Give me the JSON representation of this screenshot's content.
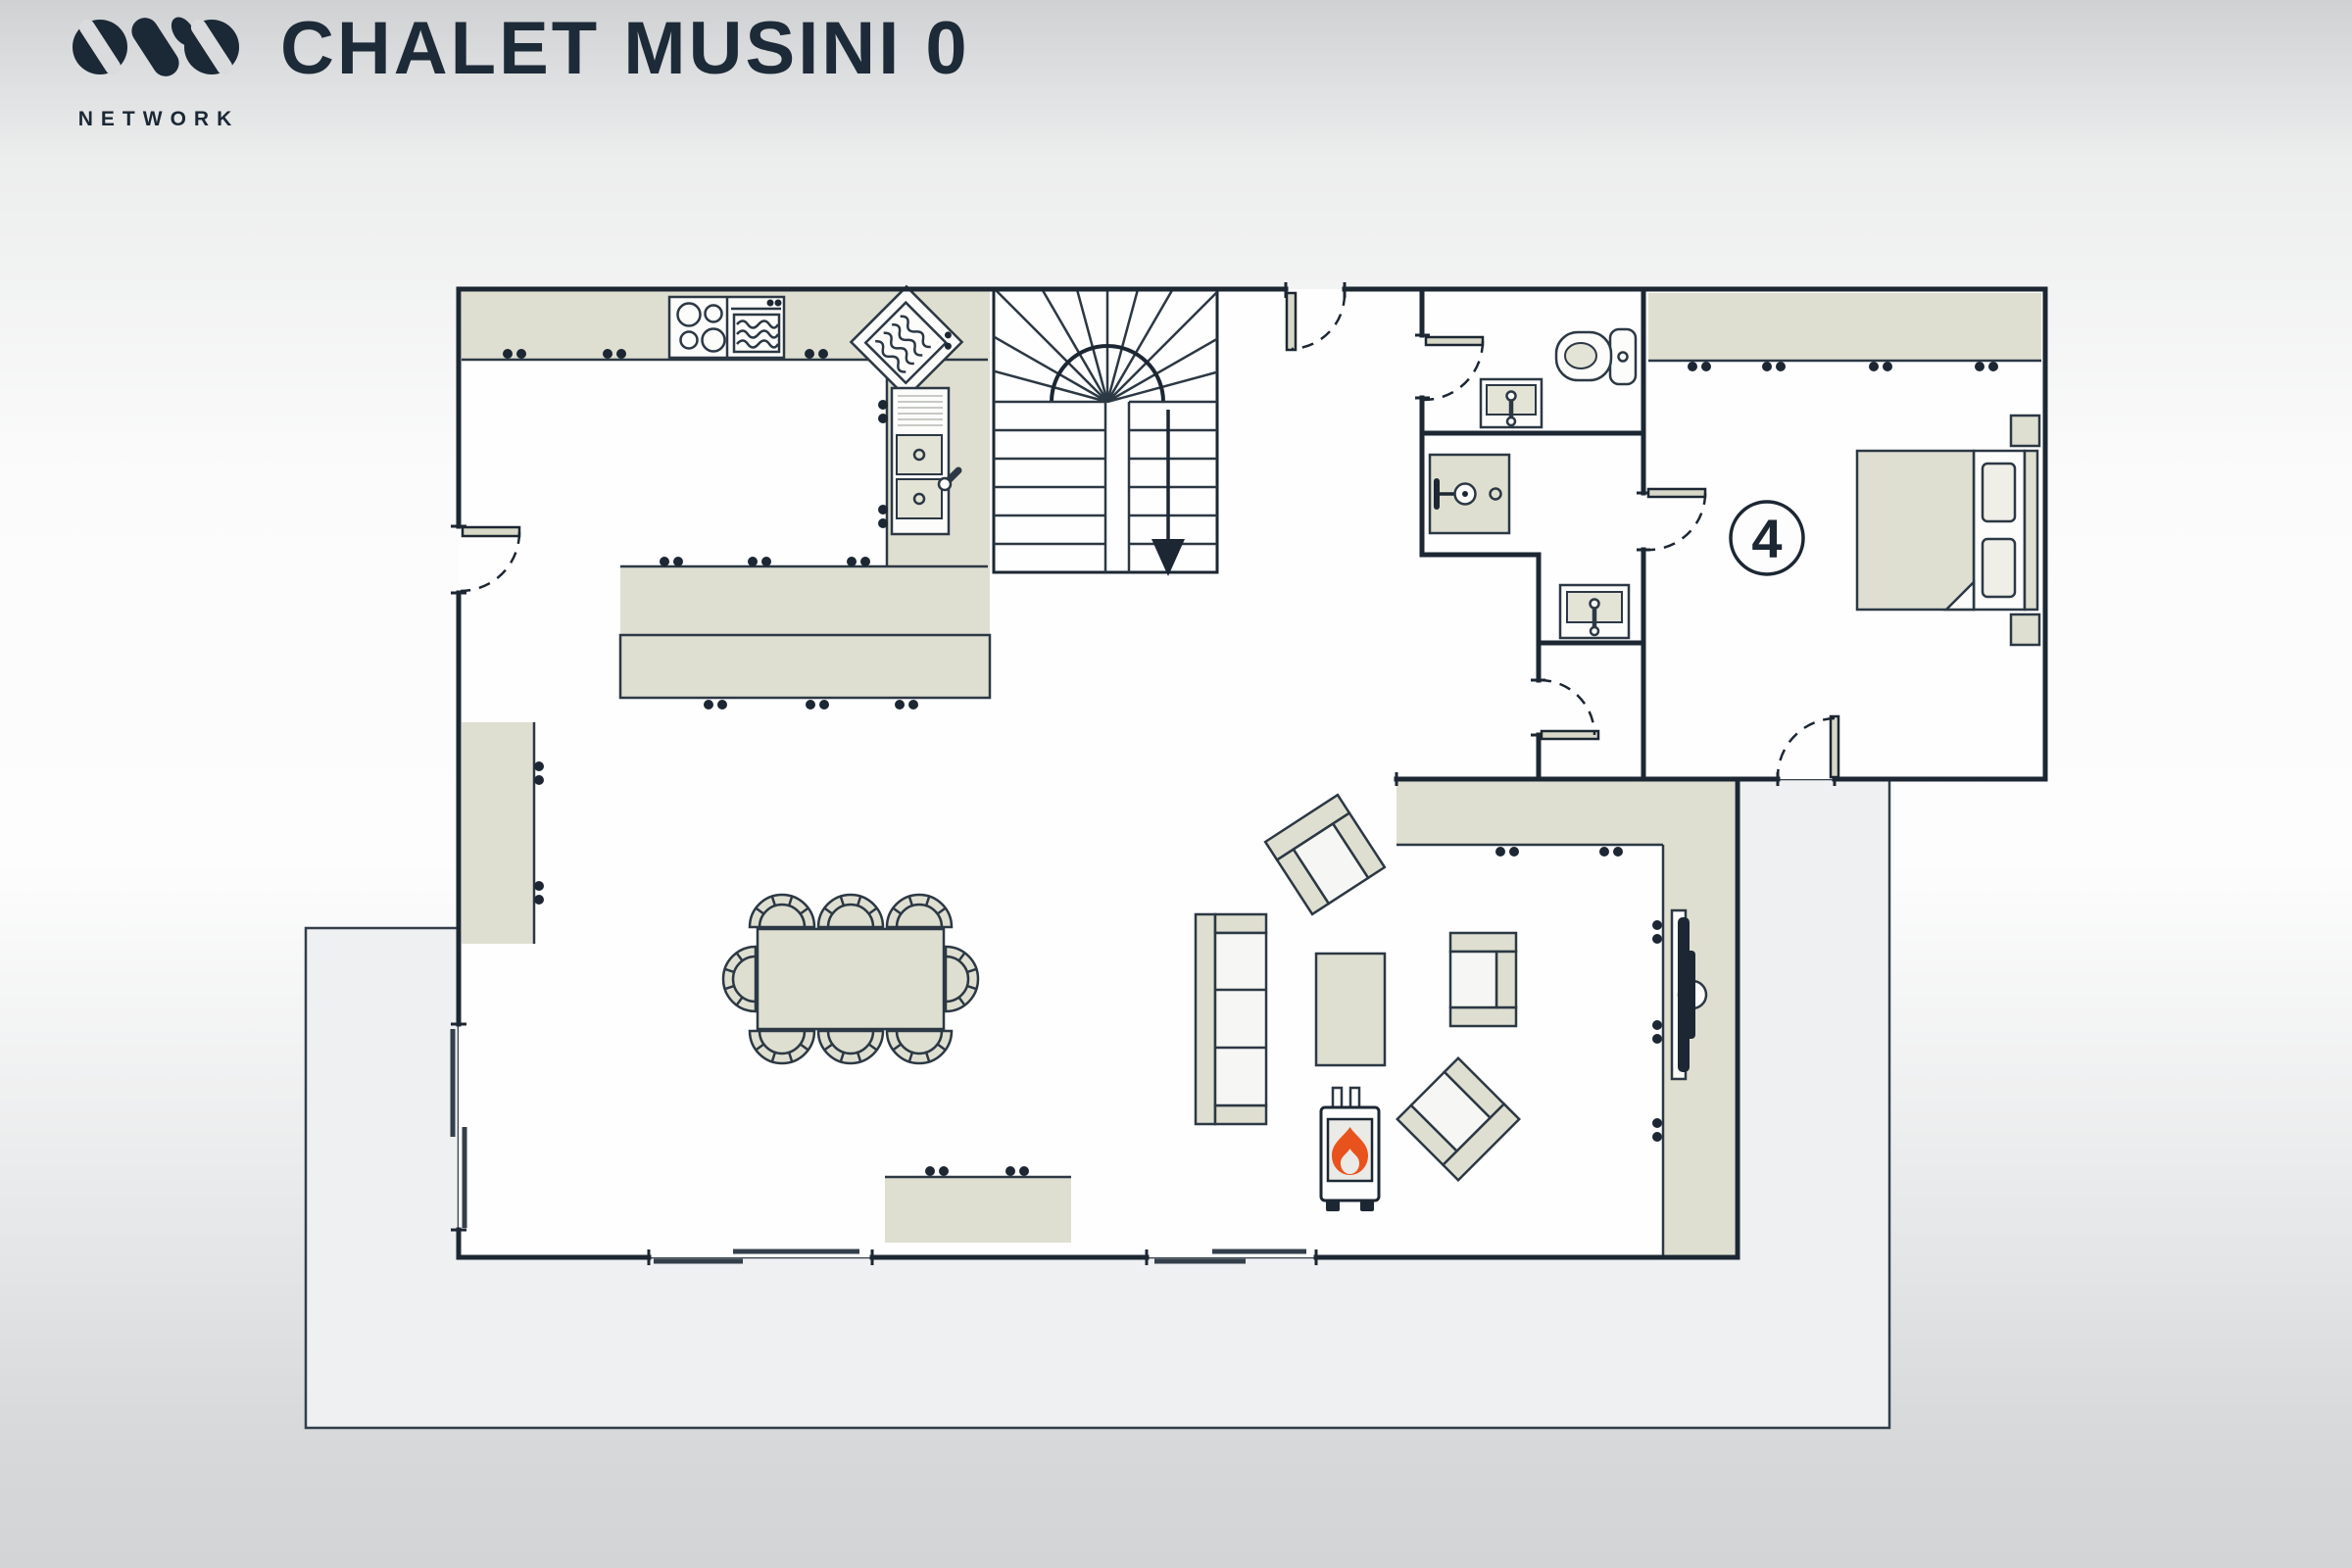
{
  "header": {
    "logo_brand": "OVO",
    "logo_subtitle": "NETWORK",
    "title": "CHALET MUSINI 0"
  },
  "floorplan": {
    "bedroom_badge": "4",
    "colors": {
      "wall": "#1c2733",
      "outline": "#2c3844",
      "furniture": "#dfdfd1",
      "seat": "#f6f7f4",
      "basin": "#e3e3d6",
      "panel": "#d8d8c8",
      "terrace": "#eff0f2",
      "flame": "#e8531d",
      "paper": "#fefefe"
    },
    "icons": {
      "stove-icon": "four burner hob",
      "oven-icon": "oven with heat waves",
      "dishwasher-icon": "rotated appliance with waves and controls",
      "kitchen-sink-icon": "double basin with tap",
      "toilet-icon": "toilet with cistern",
      "bathroom-sink-icon": "basin with tap",
      "shower-icon": "shower tray with shower head",
      "stairs-down-icon": "winder staircase with down arrow",
      "fireplace-icon": "log burner with flue",
      "flame-icon": "orange flame",
      "tv-icon": "wall mounted television",
      "door-icon": "door leaf with dashed swing arc"
    },
    "rooms": [
      "kitchen",
      "dining area",
      "living room",
      "hallway",
      "wc",
      "shower room",
      "closet",
      "bedroom 4",
      "terrace"
    ],
    "furniture": [
      "kitchen counters",
      "island unit",
      "tall cupboard",
      "dining table with 8 chairs",
      "sideboard",
      "three seat sofa",
      "armchairs",
      "coffee table",
      "log burner",
      "tv console",
      "double bed",
      "nightstands",
      "wardrobe"
    ]
  }
}
